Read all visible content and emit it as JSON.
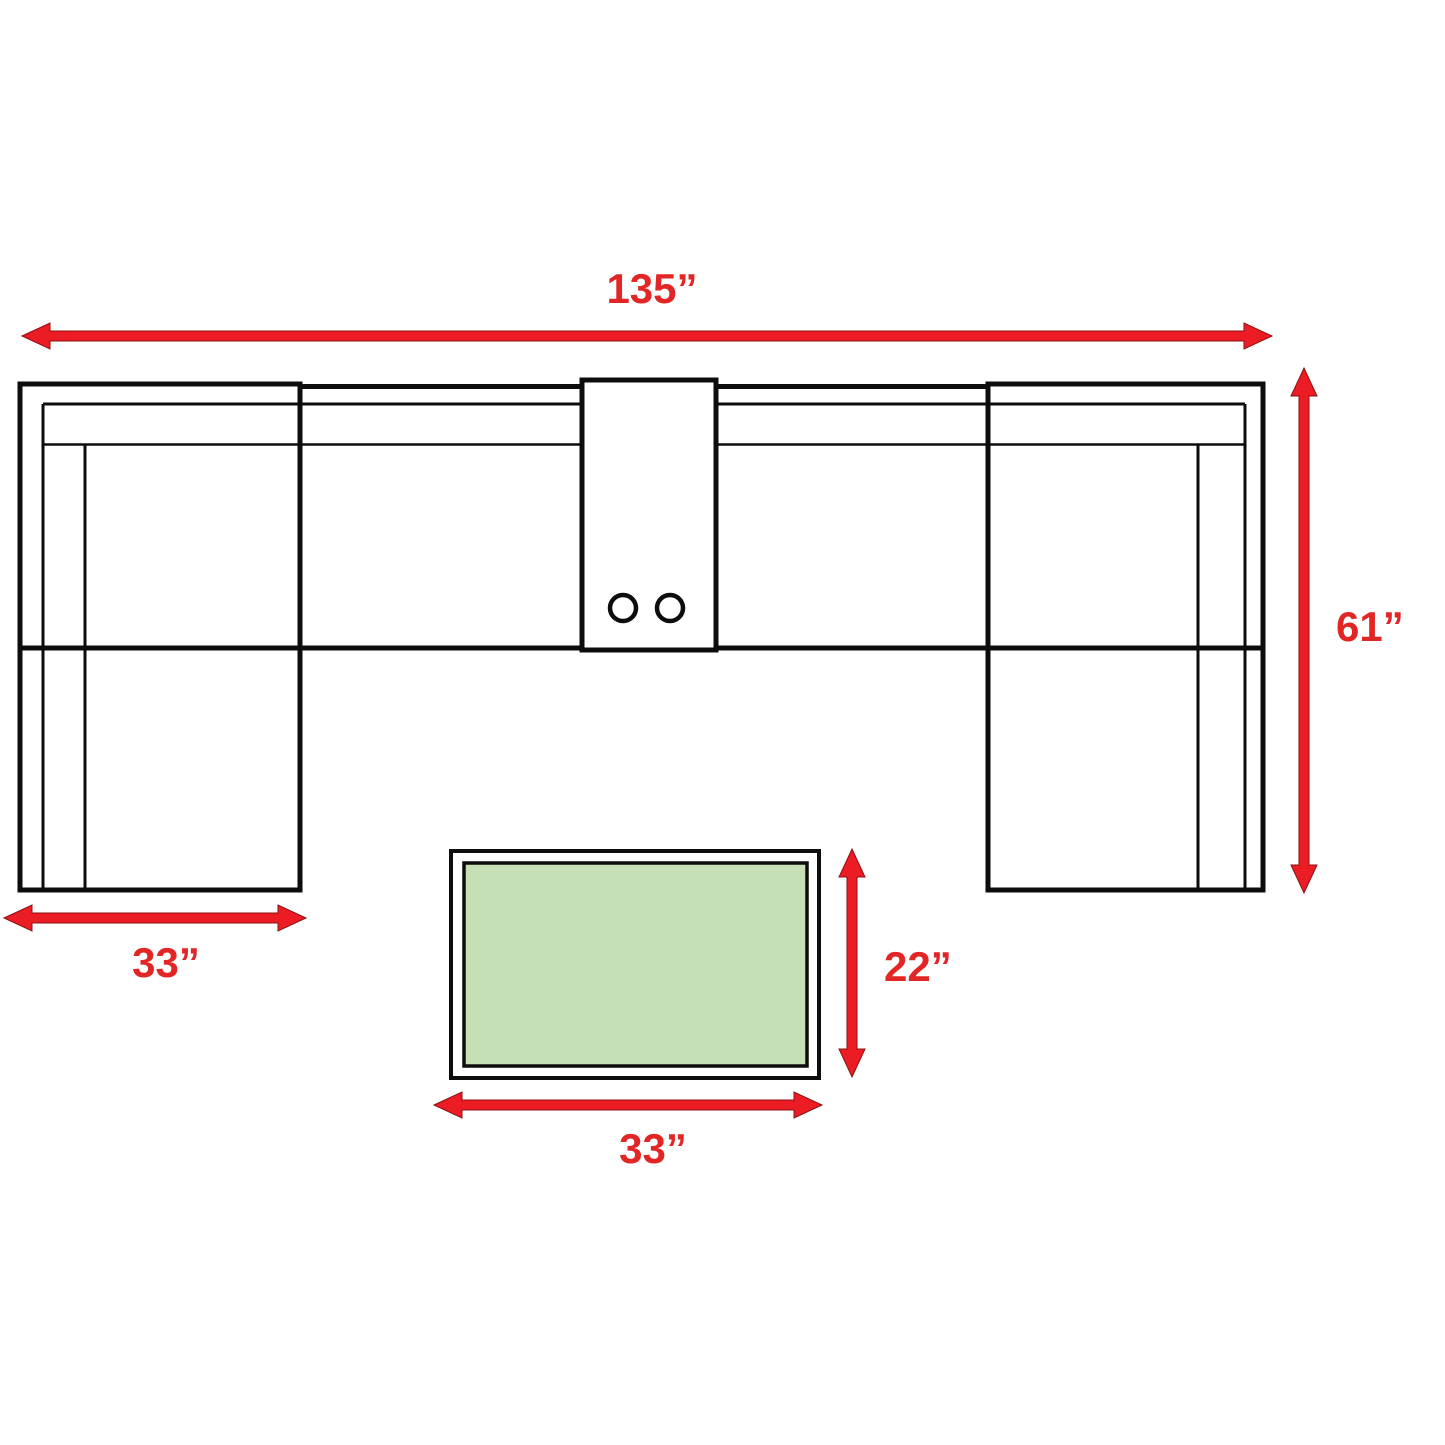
{
  "dimensions": {
    "sofa_width": {
      "label": "135”"
    },
    "sofa_depth": {
      "label": "61”"
    },
    "left_chaise_width": {
      "label": "33”"
    },
    "table_depth": {
      "label": "22”"
    },
    "table_width": {
      "label": "33”"
    }
  },
  "colors": {
    "arrow-red": "#ec1c24",
    "label-red": "#e22525",
    "line-black": "#0d0d0d",
    "table-green": "#c6dfb4",
    "background": "#ffffff"
  }
}
